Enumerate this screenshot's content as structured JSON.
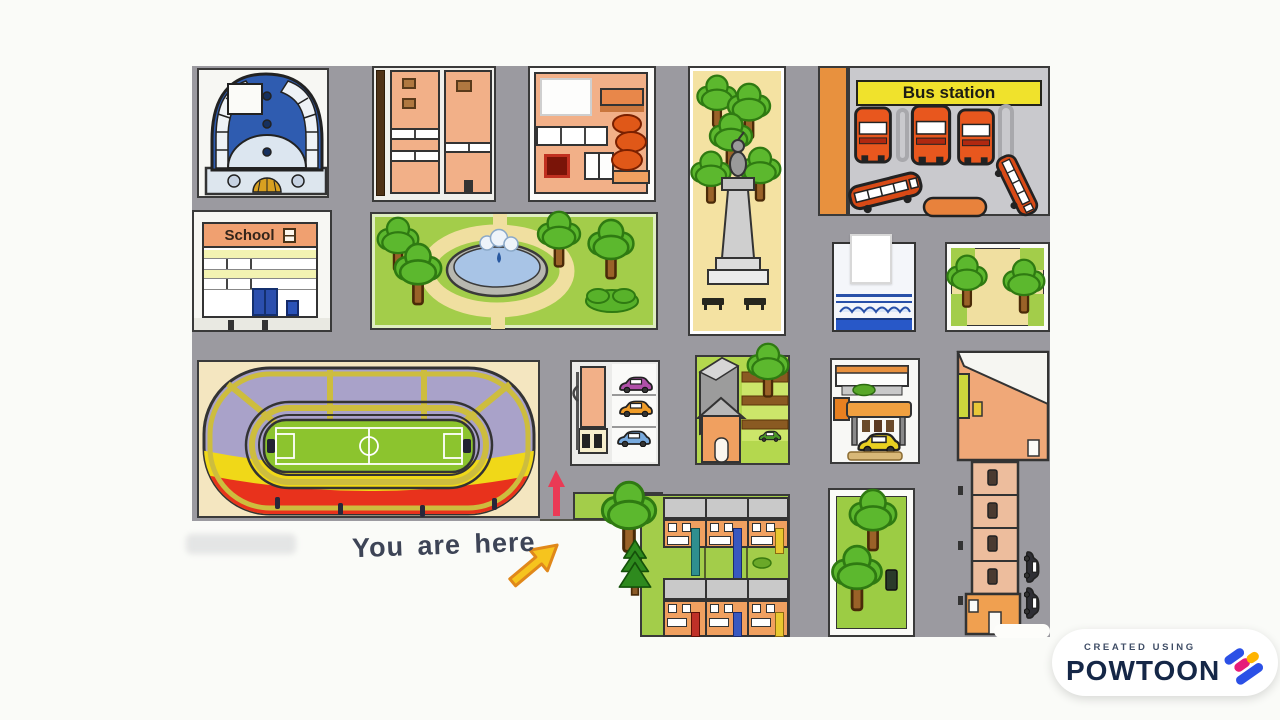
{
  "scene": {
    "background": "#fafbf8",
    "description": "Cartoon city map video frame"
  },
  "map": {
    "road_color": "#9b9aa0",
    "signs": {
      "bus_station": "Bus station",
      "school": "School"
    },
    "annotation": {
      "you_are_here": "You are here"
    },
    "colors": {
      "grass_green": "#a3cd4a",
      "tree_green": "#5cb82e",
      "plaza_sand": "#f4e2a2",
      "building_orange": "#f2b088",
      "bus_orange": "#e8571e",
      "sign_yellow": "#f0e22c",
      "school_sign_orange": "#f0a070",
      "stadium_stand_purple": "#a9a2c9",
      "stadium_yellow": "#f0d818",
      "stadium_red": "#e8321c",
      "field_green": "#8cc42e",
      "pond_blue": "#a8c4e6",
      "path_cream": "#f0dfa0",
      "dome_blue": "#2f5cb0",
      "marker_red": "#ea3a55",
      "arrow_yellow": "#f6c41e"
    },
    "icons": {
      "tree": "tree-icon",
      "pine": "pine-tree-icon",
      "bus": "bus-icon",
      "car": "car-icon",
      "statue": "statue-icon",
      "bench": "bench-icon",
      "fountain": "fountain-icon",
      "flag": "flag-icon",
      "red_arrow": "red-arrow-marker",
      "yellow_arrow": "you-are-here-arrow-icon"
    }
  },
  "watermark": {
    "created_using": "CREATED USING",
    "brand": "POWTOON"
  }
}
